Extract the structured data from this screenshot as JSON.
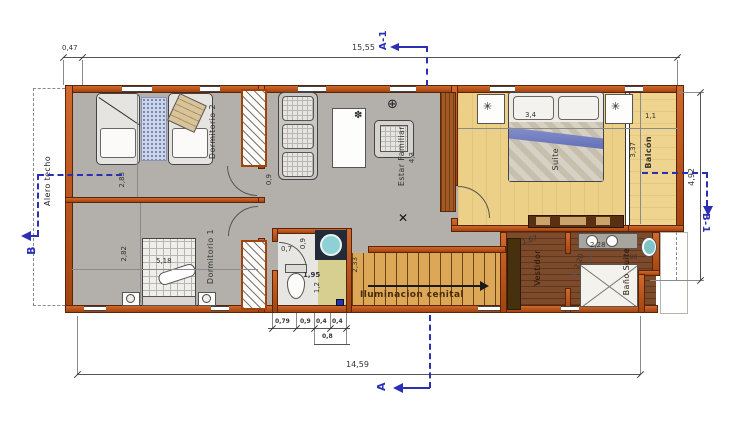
{
  "plan": {
    "rooms": {
      "dormitorio2": "Dormitorio 2",
      "dormitorio1": "Dormitorio 1",
      "estar": "Estar Familiar",
      "estar_area": "4,3",
      "suite": "Suite",
      "balcon": "Balcón",
      "vestidor": "Vestidor",
      "bano_suite": "Baño Suite",
      "stairs_note": "Iluminacion cenital"
    },
    "dims": {
      "offset_left": "0,47",
      "total_top": "15,55",
      "total_bottom": "14,59",
      "side_right": "4,92",
      "balcon_depth": "1,1",
      "balcon_length": "3,37",
      "dorm2_width": "2,83",
      "dorm1_width": "2,82",
      "dorm1_length": "5,18",
      "estar_pass": "0,9",
      "suite_bed": "3,4",
      "bath_door": "0,7",
      "bath_width": "0,9",
      "bath_length": "1,95",
      "bath_inner": "1,2",
      "stair_width": "2,33",
      "bath_row": [
        "0,79",
        "0,9",
        "0,4",
        "0,4"
      ],
      "bath_row_sub": "0,8",
      "vestidor_diag": "1,67",
      "bano_counter": "2,28",
      "bano_depth": "2,20",
      "bano_small": "0,90"
    },
    "sections": {
      "a1": "A-1",
      "a": "A",
      "b": "B",
      "b1": "B-1"
    },
    "notes": {
      "alero": "Alero techo"
    },
    "icons": {
      "light": "⊕",
      "fan": "✳",
      "flower": "✽",
      "cross": "✕"
    },
    "colors": {
      "wall": "#bf5627",
      "section_blue": "#2b2fb4",
      "floor_gray": "#b3b0ac",
      "floor_suite": "#ecd088",
      "floor_wood": "#7d4a2b",
      "floor_stairs": "#dca757"
    }
  }
}
